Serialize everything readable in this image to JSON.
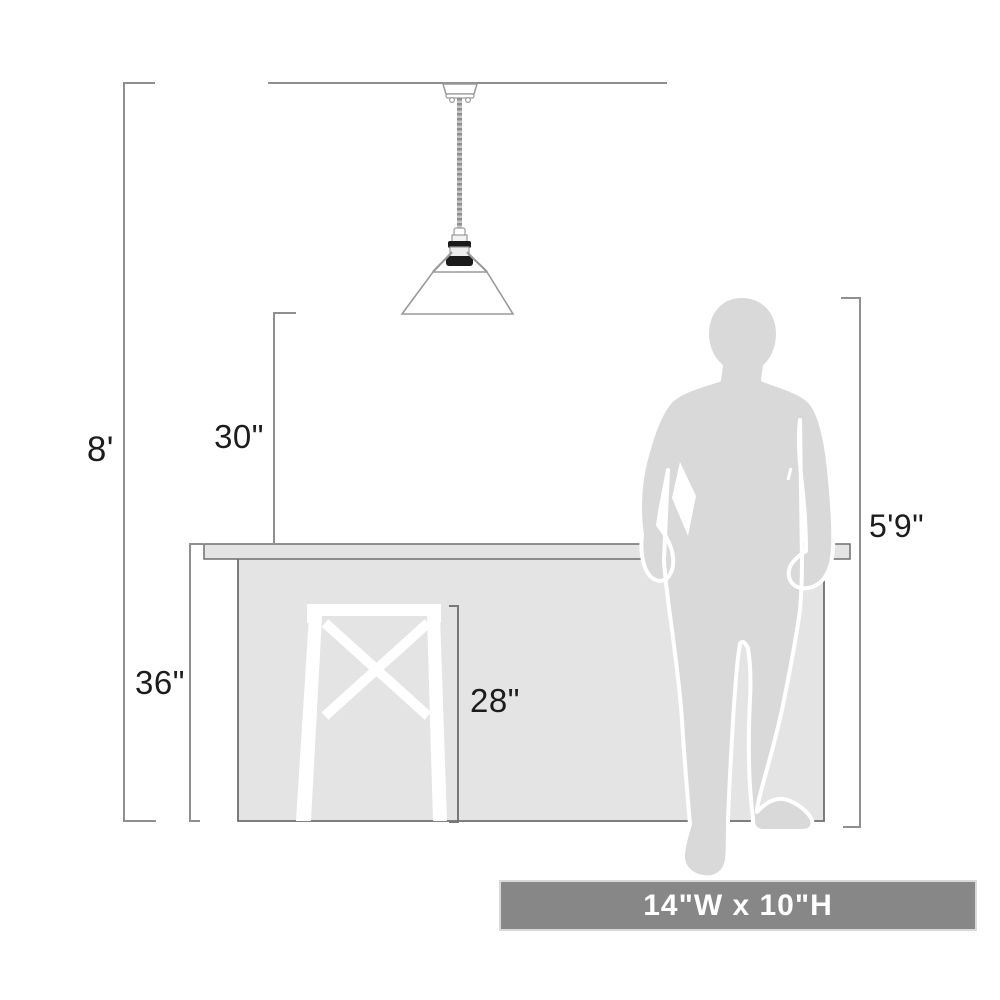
{
  "labels": {
    "ceiling_height": "8'",
    "light_to_counter": "30\"",
    "counter_height": "36\"",
    "stool_height": "28\"",
    "person_height": "5'9\""
  },
  "banner": {
    "text": "14\"W x 10\"H"
  },
  "colors": {
    "line": "#8f8f8f",
    "dark_line": "#686868",
    "text": "#1c1c1c",
    "counter_fill": "#e4e4e4",
    "person_fill": "#d9d9d9",
    "stool_fill": "#ffffff",
    "shade_fill": "#ffffff",
    "socket_dark": "#1a1a1a",
    "banner_bg": "#878787",
    "banner_text": "#ffffff"
  }
}
